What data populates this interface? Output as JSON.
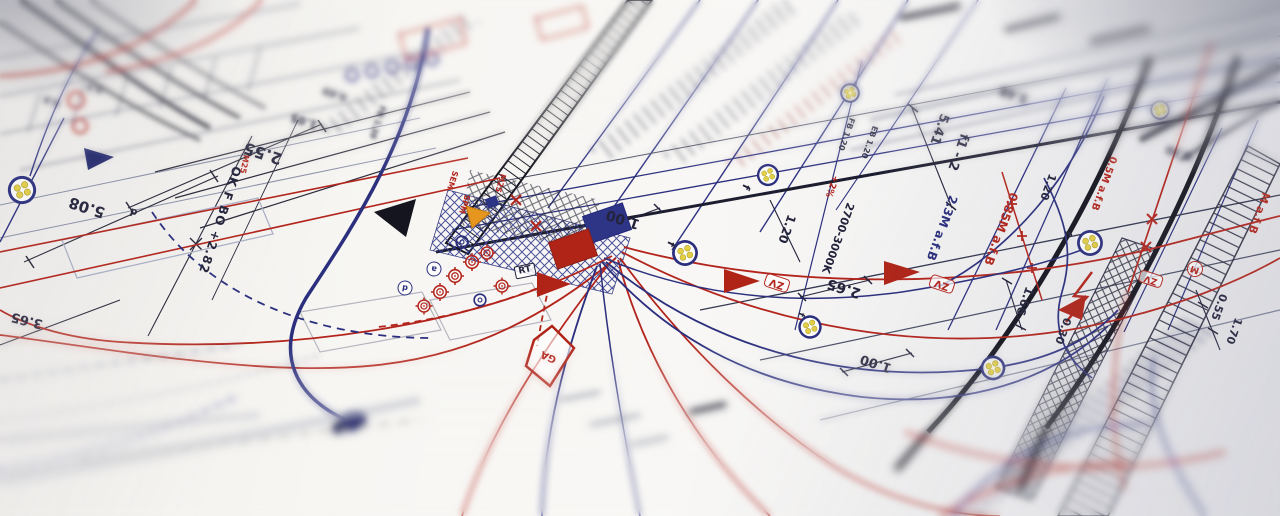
{
  "palette": {
    "ink": "#23233b",
    "red": "#b3251c",
    "navy": "#2b2f7d",
    "orange": "#e6961e",
    "yellow": "#e3cf46",
    "paper": "#f7f6f3"
  },
  "annotations": [
    {
      "name": "dim-2-55",
      "text": "2.55",
      "x": 263,
      "y": 153,
      "rot": 198,
      "size": 16,
      "color": "ink"
    },
    {
      "name": "dim-1-05",
      "text": "1.05",
      "x": 304,
      "y": 121,
      "rot": 198,
      "size": 11,
      "color": "ink",
      "blur": 1.5
    },
    {
      "name": "dim-0-69",
      "text": "0.69",
      "x": 335,
      "y": 93,
      "rot": 198,
      "size": 10,
      "color": "ink",
      "blur": 2
    },
    {
      "name": "dim-5-08",
      "text": "5.08",
      "x": 87,
      "y": 207,
      "rot": 198,
      "size": 15,
      "color": "ink"
    },
    {
      "name": "dim-3-65",
      "text": "3.65",
      "x": 27,
      "y": 320,
      "rot": 194,
      "size": 13,
      "color": "ink"
    },
    {
      "name": "label-ok-f-bo",
      "text": "OK F BO +2.82",
      "x": 220,
      "y": 220,
      "rot": 108,
      "size": 12,
      "color": "ink",
      "spacing": 1
    },
    {
      "name": "label-m25-left",
      "text": "M25",
      "x": 244,
      "y": 164,
      "rot": 102,
      "size": 8,
      "color": "red"
    },
    {
      "name": "label-fb-120-left",
      "text": "FB 1.20",
      "x": 377,
      "y": 122,
      "rot": 108,
      "size": 8,
      "color": "ink",
      "blur": 1.5
    },
    {
      "name": "label-sem",
      "text": "SEM",
      "x": 452,
      "y": 180,
      "rot": 108,
      "size": 8,
      "color": "red"
    },
    {
      "name": "label-spm",
      "text": "SPM",
      "x": 464,
      "y": 204,
      "rot": 108,
      "size": 8,
      "color": "red"
    },
    {
      "name": "label-m25-center",
      "text": "M25",
      "x": 500,
      "y": 183,
      "rot": 108,
      "size": 8,
      "color": "red"
    },
    {
      "name": "label-rt",
      "text": "RT",
      "x": 525,
      "y": 271,
      "rot": -12,
      "size": 9,
      "color": "ink",
      "style": "box-dark"
    },
    {
      "name": "label-ga",
      "text": "GA",
      "x": 549,
      "y": 356,
      "rot": 205,
      "size": 10,
      "color": "red",
      "weight": 700
    },
    {
      "name": "dim-1-00-center",
      "text": "1.00",
      "x": 623,
      "y": 219,
      "rot": 198,
      "size": 14,
      "color": "ink"
    },
    {
      "name": "label-f-1",
      "text": "f",
      "x": 671,
      "y": 244,
      "rot": 115,
      "size": 11,
      "color": "ink"
    },
    {
      "name": "label-f-2",
      "text": "f",
      "x": 746,
      "y": 187,
      "rot": 115,
      "size": 11,
      "color": "ink"
    },
    {
      "name": "dim-1-20-center",
      "text": "1.20",
      "x": 787,
      "y": 229,
      "rot": 110,
      "size": 12,
      "color": "ink"
    },
    {
      "name": "label-2700-3000k",
      "text": "2700-3000K",
      "x": 838,
      "y": 238,
      "rot": 110,
      "size": 11,
      "color": "ink"
    },
    {
      "name": "label-fb-120",
      "text": "FB 1.20",
      "x": 846,
      "y": 134,
      "rot": 110,
      "size": 8,
      "color": "ink"
    },
    {
      "name": "label-eb-120",
      "text": "EB 1.20",
      "x": 869,
      "y": 142,
      "rot": 110,
      "size": 8,
      "color": "ink"
    },
    {
      "name": "label-plus-2pct",
      "text": "+2%",
      "x": 831,
      "y": 186,
      "rot": 110,
      "size": 9,
      "color": "red"
    },
    {
      "name": "dim-5-41",
      "text": "5.41",
      "x": 939,
      "y": 129,
      "rot": 110,
      "size": 13,
      "color": "ink"
    },
    {
      "name": "label-f1-2",
      "text": "f1 - 2",
      "x": 958,
      "y": 152,
      "rot": 110,
      "size": 13,
      "color": "ink"
    },
    {
      "name": "label-23m-afb",
      "text": "2.3M a.f.B",
      "x": 942,
      "y": 228,
      "rot": 110,
      "size": 12,
      "color": "navy"
    },
    {
      "name": "label-085m-afb",
      "text": "0.85M a.f.B",
      "x": 1001,
      "y": 229,
      "rot": 110,
      "size": 12,
      "color": "red"
    },
    {
      "name": "label-05m-afb",
      "text": "0.5M a.f.B",
      "x": 1103,
      "y": 183,
      "rot": 110,
      "size": 10,
      "color": "red"
    },
    {
      "name": "label-m-afb-edge",
      "text": "M a.f.B",
      "x": 1259,
      "y": 213,
      "rot": 110,
      "size": 11,
      "color": "red"
    },
    {
      "name": "dim-2-65",
      "text": "2.65",
      "x": 844,
      "y": 288,
      "rot": 198,
      "size": 14,
      "color": "ink"
    },
    {
      "name": "dim-1-00-right",
      "text": "1.00",
      "x": 876,
      "y": 363,
      "rot": 198,
      "size": 13,
      "color": "ink"
    },
    {
      "name": "dim-3-48",
      "text": "3.48",
      "x": 1014,
      "y": 95,
      "rot": 198,
      "size": 12,
      "color": "ink",
      "blur": 2
    },
    {
      "name": "dim-0-30-top",
      "text": "0.30",
      "x": 1179,
      "y": 153,
      "rot": 198,
      "size": 11,
      "color": "ink",
      "blur": 2.5
    },
    {
      "name": "dim-1-66",
      "text": "1.66",
      "x": 1025,
      "y": 301,
      "rot": 110,
      "size": 12,
      "color": "ink"
    },
    {
      "name": "dim-0-30-right",
      "text": "0.30",
      "x": 1063,
      "y": 331,
      "rot": 110,
      "size": 11,
      "color": "ink"
    },
    {
      "name": "dim-0-55",
      "text": "0.55",
      "x": 1219,
      "y": 307,
      "rot": 110,
      "size": 11,
      "color": "ink"
    },
    {
      "name": "dim-1-70",
      "text": "1.70",
      "x": 1234,
      "y": 331,
      "rot": 110,
      "size": 11,
      "color": "ink"
    },
    {
      "name": "dim-1-20-right",
      "text": "1.20",
      "x": 1048,
      "y": 187,
      "rot": 110,
      "size": 11,
      "color": "ink"
    },
    {
      "name": "label-zv-1",
      "text": "ZV",
      "x": 777,
      "y": 283,
      "rot": 198,
      "size": 10,
      "color": "red",
      "style": "box-red"
    },
    {
      "name": "label-zv-2",
      "text": "ZV",
      "x": 942,
      "y": 284,
      "rot": 198,
      "size": 10,
      "color": "red",
      "style": "box-red"
    },
    {
      "name": "label-zv-3",
      "text": "ZV",
      "x": 1151,
      "y": 279,
      "rot": 198,
      "size": 9,
      "color": "red",
      "style": "box-red"
    },
    {
      "name": "label-m-motor",
      "text": "M",
      "x": 1195,
      "y": 269,
      "rot": 200,
      "size": 9,
      "color": "red",
      "style": "circle-red"
    },
    {
      "name": "label-a-circle",
      "text": "a",
      "x": 434,
      "y": 269,
      "rot": 190,
      "size": 8,
      "color": "navy",
      "style": "circle-blue"
    },
    {
      "name": "label-d-circle",
      "text": "d",
      "x": 405,
      "y": 288,
      "rot": 190,
      "size": 8,
      "color": "navy",
      "style": "circle-blue"
    },
    {
      "name": "label-d-left",
      "text": "d",
      "x": 134,
      "y": 211,
      "rot": 196,
      "size": 10,
      "color": "ink"
    },
    {
      "name": "label-f-3",
      "text": "f",
      "x": 1067,
      "y": 233,
      "rot": 110,
      "size": 10,
      "color": "ink"
    },
    {
      "name": "label-f-4",
      "text": "f",
      "x": 800,
      "y": 314,
      "rot": 110,
      "size": 9,
      "color": "ink"
    },
    {
      "name": "dim-0-8-blur",
      "text": "0.8",
      "x": 52,
      "y": 100,
      "rot": 198,
      "size": 9,
      "color": "ink",
      "blur": 2.5
    },
    {
      "name": "dim-0-5-blur",
      "text": "0.5",
      "x": 95,
      "y": 87,
      "rot": 198,
      "size": 9,
      "color": "ink",
      "blur": 2.5
    }
  ]
}
